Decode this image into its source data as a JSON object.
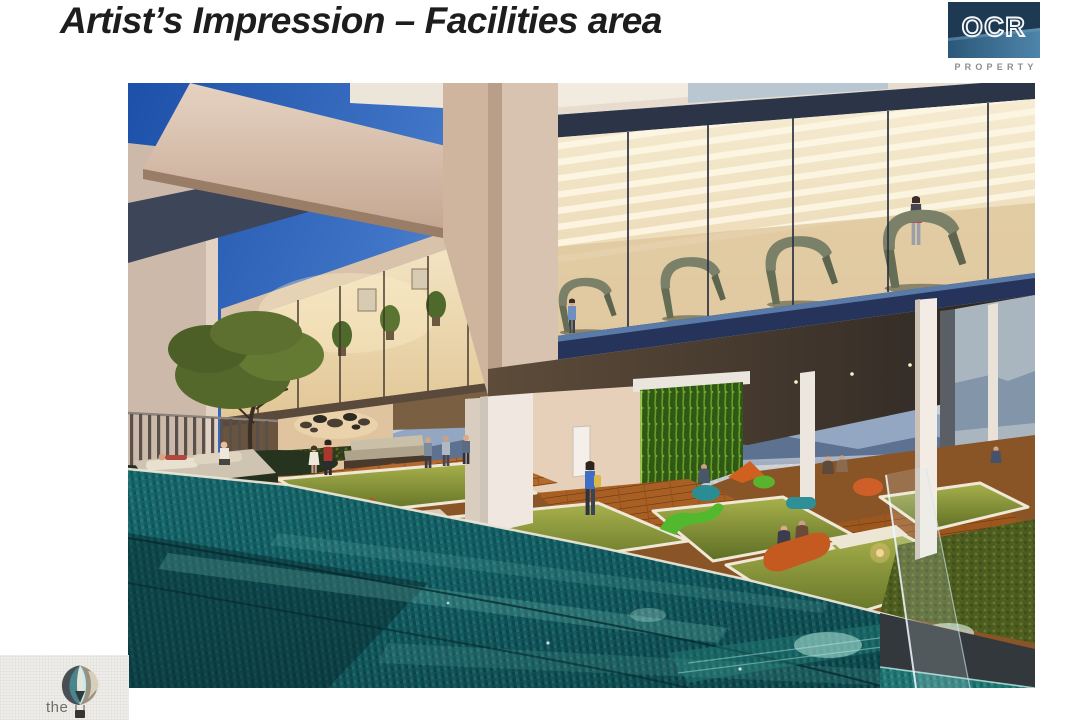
{
  "slide": {
    "title": "Artist’s Impression – Facilities area"
  },
  "logos": {
    "ocr": {
      "acronym": "OCR",
      "tagline": "PROPERTY"
    },
    "balloon": {
      "word": "the"
    }
  },
  "artwork": {
    "alt": "Artist's impression of the facilities deck at dusk: glass-walled gym with treadmills above an open lounge terrace with lawns, colourful bean bags, timber decking, a vertical green wall and an infinity lap pool overlooking hills and city lights"
  },
  "palette": {
    "page_bg": "#ffffff",
    "title_color": "#1d1d1d",
    "ocr_navy": "#1d3a52",
    "ocr_steel": "#40749a",
    "ocr_tagline_gray": "#8d8d8d",
    "balloon_word_gray": "#6f6e68",
    "sky_deep_blue": "#1d50a8",
    "dusk_haze": "#cfd9e4",
    "pool_teal": "#156067",
    "lawn_green": "#8c9a3e",
    "deck_wood": "#a35d24",
    "green_wall_green": "#4f7d22",
    "gym_glow_cream": "#f6ecd2",
    "structure_navy": "#2c3548",
    "beanbag_orange": "#cf5f28",
    "beanbag_green": "#55b42e",
    "beanbag_teal": "#2b8d94"
  }
}
